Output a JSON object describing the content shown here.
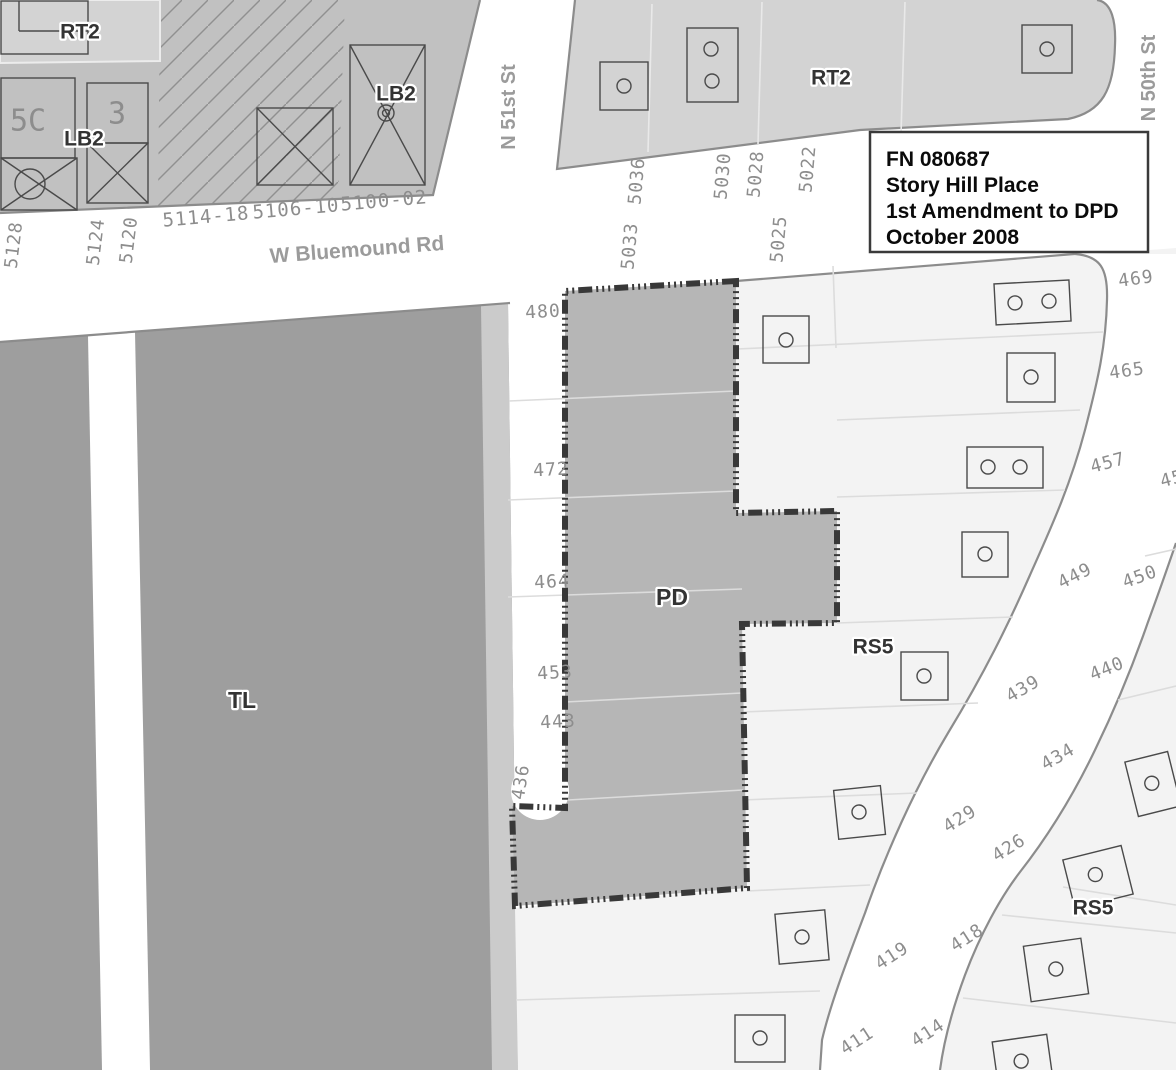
{
  "map_title_box": {
    "line1": "FN 080687",
    "line2": "Story Hill Place",
    "line3": "1st Amendment to DPD",
    "line4": "October 2008"
  },
  "streets": {
    "w_bluemound_rd": "W Bluemound Rd",
    "n_51st_st": "N 51st St",
    "n_50th_st": "N 50th St"
  },
  "zone_labels": {
    "rt2_northwest": "RT2",
    "lb2_west": "LB2",
    "lb2_east": "LB2",
    "rt2_northeast": "RT2",
    "tl": "TL",
    "pd": "PD",
    "rs5_north": "RS5",
    "rs5_southeast": "RS5"
  },
  "building_labels": {
    "building_5c": "5C",
    "building_3": "3"
  },
  "addresses": {
    "bluemound_north_west": [
      "5128",
      "5124",
      "5120",
      "5114-18",
      "5106-10",
      "5100-02"
    ],
    "bluemound_north_east": [
      "5036",
      "5030",
      "5028",
      "5022"
    ],
    "bluemound_south": [
      "5033",
      "5025"
    ],
    "pd_west_lots": [
      "480",
      "472",
      "464",
      "453",
      "443",
      "436"
    ],
    "street_west_side": [
      "469",
      "465",
      "457",
      "449",
      "439",
      "429",
      "419",
      "411"
    ],
    "street_east_side": [
      "45",
      "450",
      "440",
      "434",
      "426",
      "418",
      "414"
    ]
  },
  "colors": {
    "zone_rt2_light": "#d3d3d3",
    "zone_commercial": "#c1c1c1",
    "zone_tl_dark": "#9e9e9e",
    "zone_pd": "#b6b6b6",
    "lots_light": "#f3f3f3",
    "road_white": "#ffffff",
    "band_gray": "#cbcbcb",
    "boundary_dash": "#383838",
    "curb_gray": "#8c8c8c",
    "text_gray": "#8d8d8d",
    "label_dark": "#333333"
  }
}
